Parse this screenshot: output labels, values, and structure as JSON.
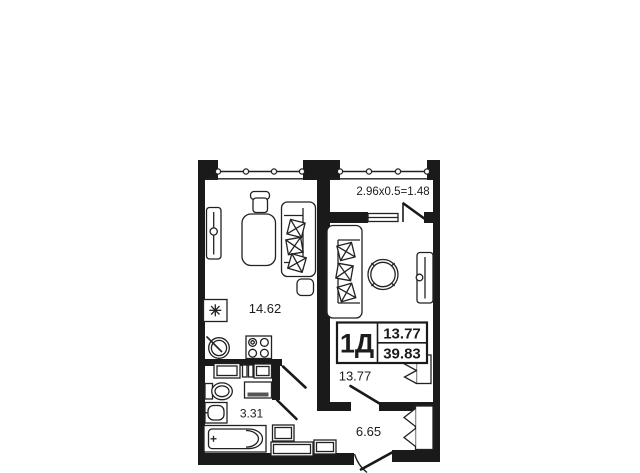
{
  "plan": {
    "balcony_dimension": "2.96x0.5=1.48",
    "rooms": {
      "living_kitchen": {
        "area": "14.62"
      },
      "bedroom": {
        "area": "13.77"
      },
      "bathroom": {
        "area": "3.31"
      },
      "hallway": {
        "area": "6.65"
      }
    },
    "stamp": {
      "apartment_type": "1Д",
      "living_area": "13.77",
      "total_area": "39.83"
    },
    "icons": {
      "fridge": "snowflake-asterisk",
      "stove": "four-burner-circles",
      "kitchen_sink": "circle-with-tap-line",
      "wardrobe": "rounded-rect-with-rail",
      "sofa": "rect-with-x-cushions",
      "door_swing": "diagonal-leaf-line",
      "window_glazing": "line-with-circle-posts"
    },
    "colors": {
      "wall": "#1a1a1a",
      "line": "#222222",
      "text": "#1c1c1c",
      "background": "#ffffff"
    }
  }
}
